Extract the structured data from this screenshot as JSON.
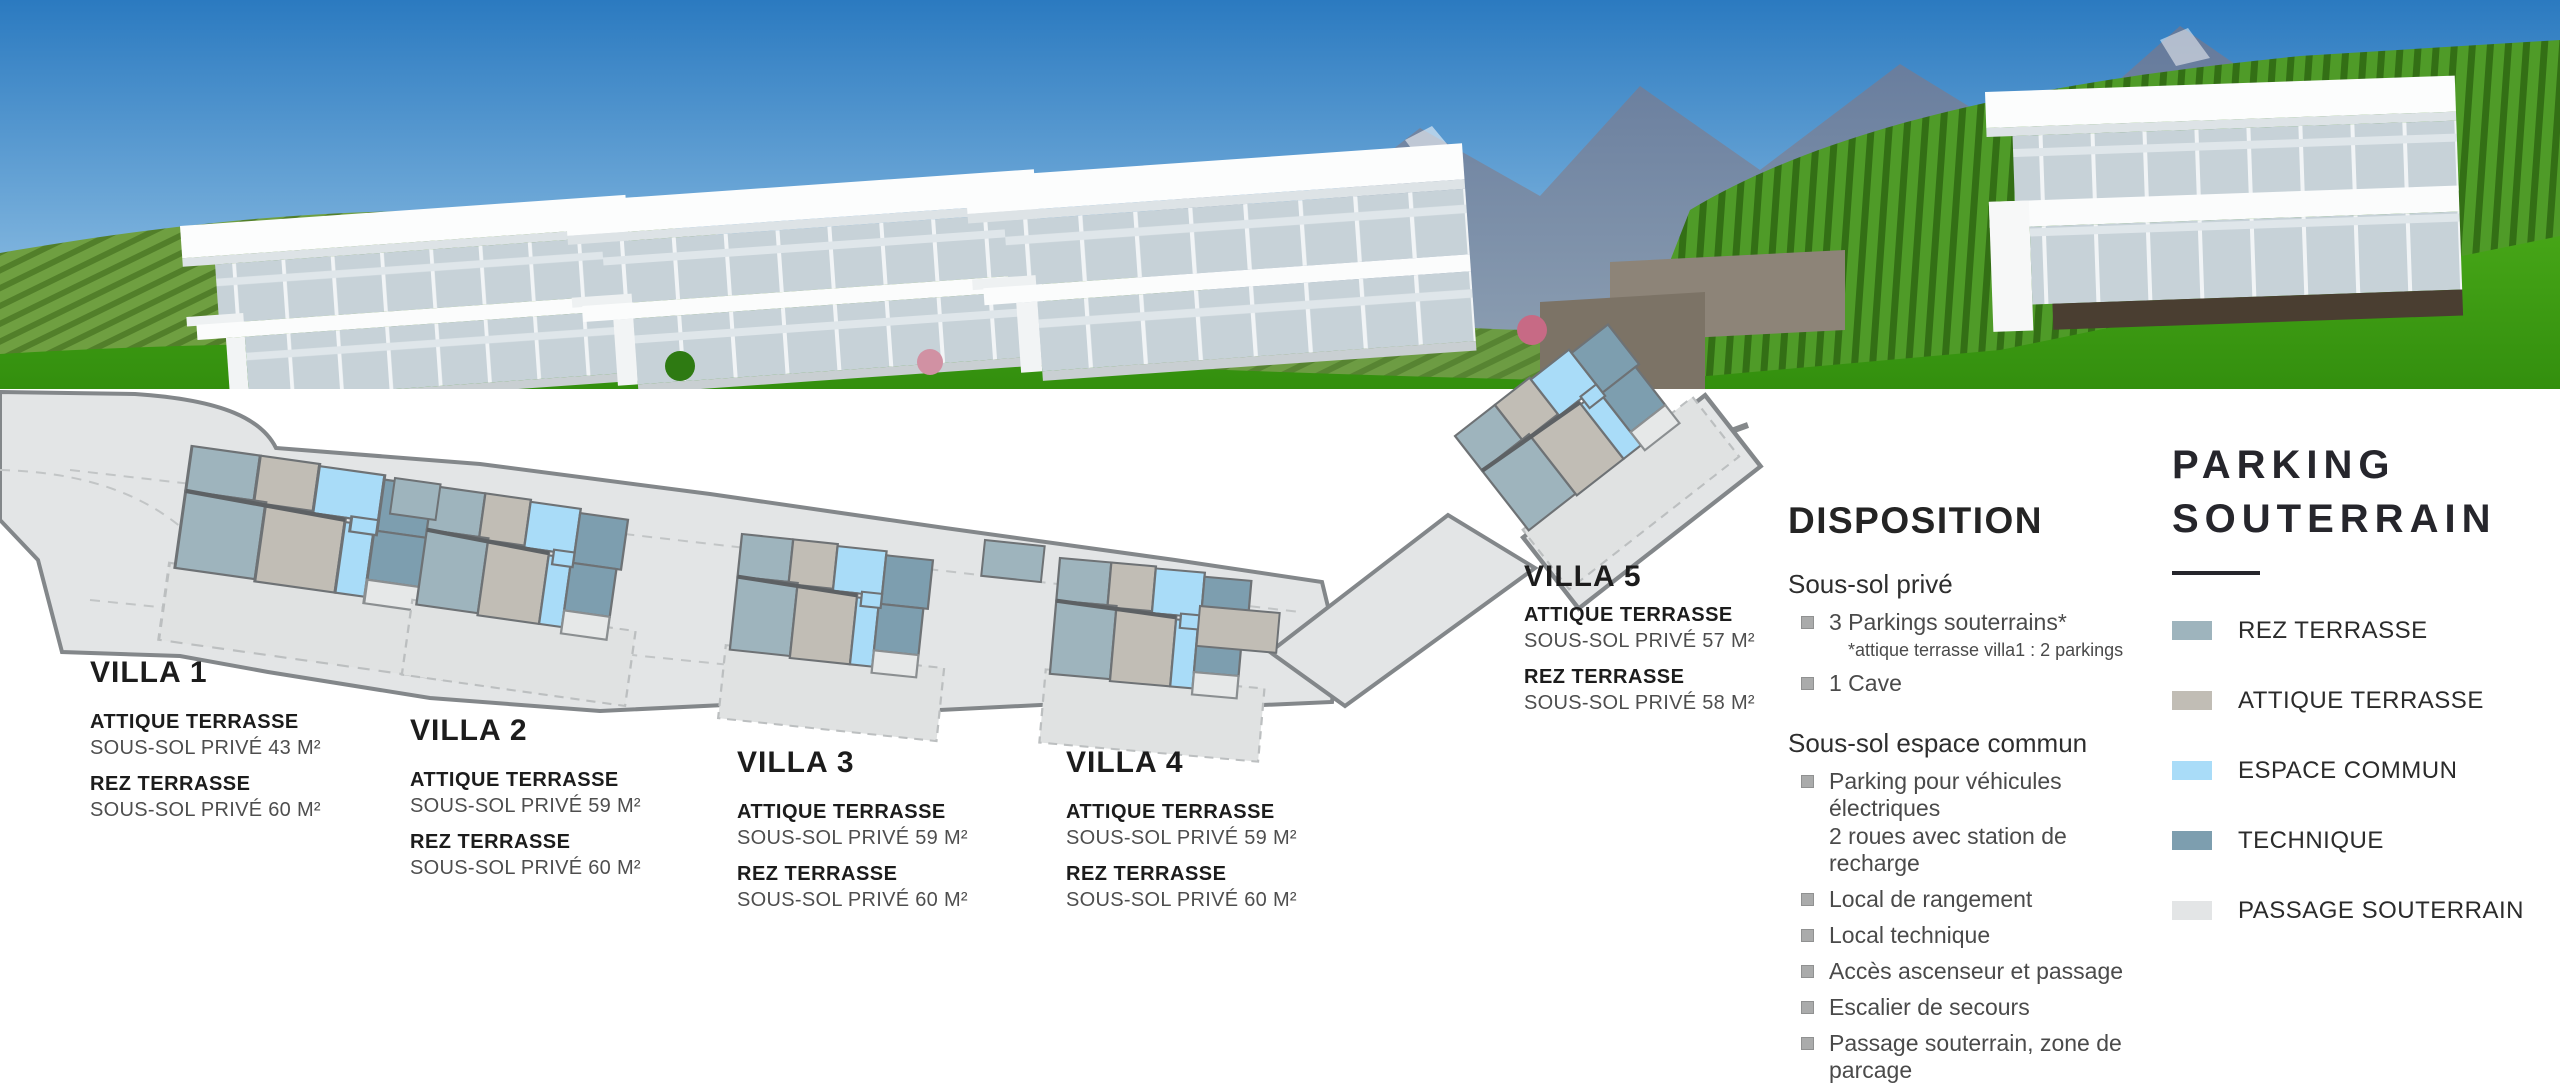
{
  "photo": {
    "colors": {
      "sky": "#2b7ac0",
      "mountains": "#64799b",
      "vineyard": "#527f2a",
      "grass": "#3f9a12",
      "villas": "#fbfcfd",
      "glass": "#c7d2d8"
    }
  },
  "villas": [
    {
      "name": "VILLA 1",
      "attique_label": "ATTIQUE TERRASSE",
      "attique_value": "SOUS-SOL PRIVÉ 43 M²",
      "rez_label": "REZ TERRASSE",
      "rez_value": "SOUS-SOL PRIVÉ 60 M²"
    },
    {
      "name": "VILLA 2",
      "attique_label": "ATTIQUE TERRASSE",
      "attique_value": "SOUS-SOL PRIVÉ 59 M²",
      "rez_label": "REZ TERRASSE",
      "rez_value": "SOUS-SOL PRIVÉ 60 M²"
    },
    {
      "name": "VILLA 3",
      "attique_label": "ATTIQUE TERRASSE",
      "attique_value": "SOUS-SOL PRIVÉ 59 M²",
      "rez_label": "REZ TERRASSE",
      "rez_value": "SOUS-SOL PRIVÉ 60 M²"
    },
    {
      "name": "VILLA 4",
      "attique_label": "ATTIQUE TERRASSE",
      "attique_value": "SOUS-SOL PRIVÉ 59 M²",
      "rez_label": "REZ TERRASSE",
      "rez_value": "SOUS-SOL PRIVÉ 60 M²"
    },
    {
      "name": "VILLA 5",
      "attique_label": "ATTIQUE TERRASSE",
      "attique_value": "SOUS-SOL PRIVÉ 57 M²",
      "rez_label": "REZ TERRASSE",
      "rez_value": "SOUS-SOL PRIVÉ 58 M²"
    }
  ],
  "disposition": {
    "title": "DISPOSITION",
    "prive": {
      "heading": "Sous-sol privé",
      "item1": "3 Parkings souterrains*",
      "note": "*attique terrasse villa1 : 2 parkings",
      "item2": "1 Cave"
    },
    "commun": {
      "heading": "Sous-sol espace commun",
      "item1a": "Parking pour véhicules électriques",
      "item1b": "2 roues avec station de recharge",
      "item2": "Local de rangement",
      "item3": "Local technique",
      "item4": "Accès ascenseur et passage",
      "item5": "Escalier de secours",
      "item6": "Passage souterrain, zone de parcage"
    }
  },
  "legend": {
    "title": "PARKING SOUTERRAIN",
    "items": [
      {
        "label": "REZ TERRASSE",
        "color": "#9eb4bd"
      },
      {
        "label": "ATTIQUE TERRASSE",
        "color": "#c1bdb5"
      },
      {
        "label": "ESPACE COMMUN",
        "color": "#a9dcf8"
      },
      {
        "label": "TECHNIQUE",
        "color": "#7d9eaf"
      },
      {
        "label": "PASSAGE SOUTERRAIN",
        "color": "#e3e5e6"
      }
    ]
  }
}
